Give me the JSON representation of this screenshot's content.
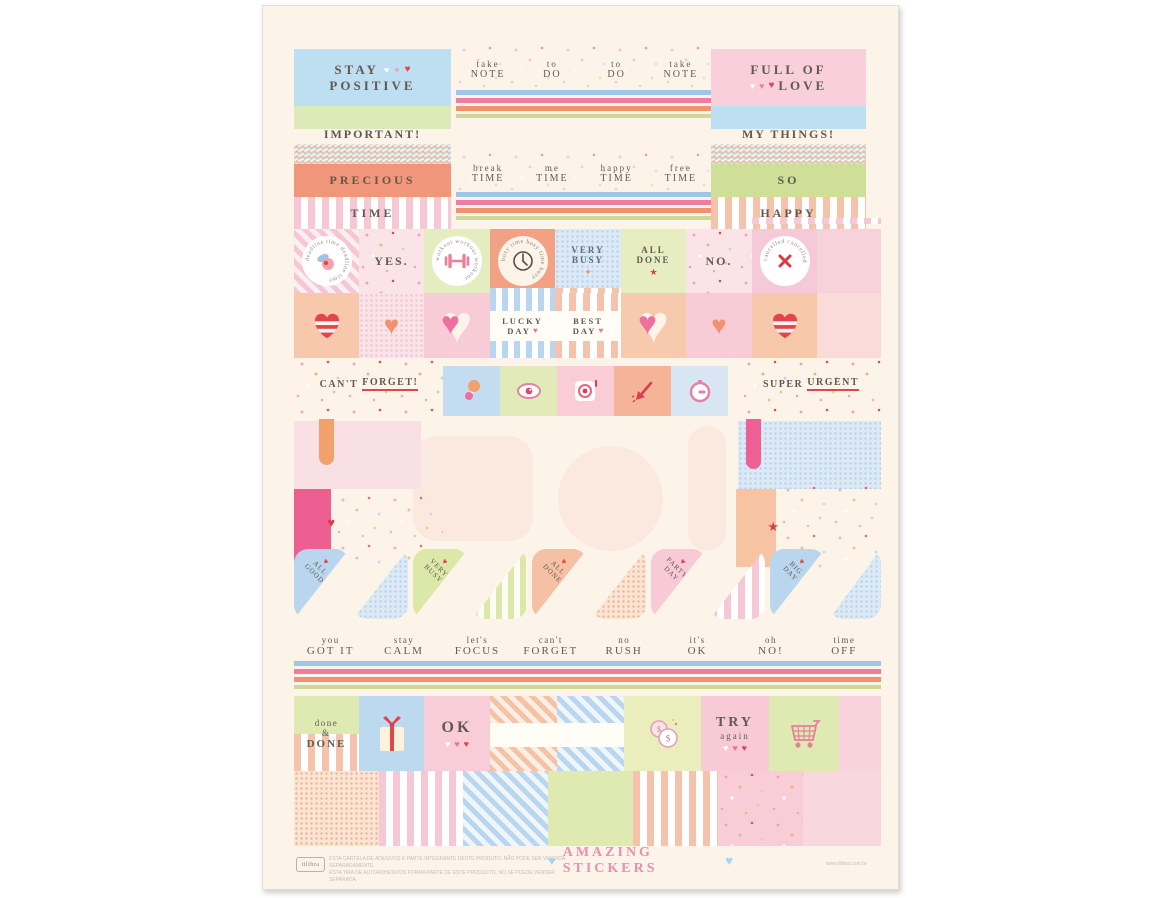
{
  "page": {
    "background": "#ffffff",
    "sheet_background": "#fdf4e9"
  },
  "icons": {
    "heart": "♥",
    "star": "★",
    "sparkle": "✦",
    "dollar": "$"
  },
  "colors": {
    "blue": "#bedff2",
    "green": "#dfe9b2",
    "pink": "#f8cdd8",
    "salmon": "#f0977b",
    "peach": "#f6c3a3",
    "red": "#e2454e",
    "hot_pink": "#ec5f90",
    "text": "#625a52",
    "title_pink": "#ea8fae"
  },
  "top_row": {
    "stay_positive": {
      "line1": "STAY",
      "line2": "POSITIVE"
    },
    "washi_notes": [
      {
        "top": "take",
        "bottom": "NOTE"
      },
      {
        "top": "to",
        "bottom": "DO"
      },
      {
        "top": "to",
        "bottom": "DO"
      },
      {
        "top": "take",
        "bottom": "NOTE"
      }
    ],
    "full_of_love": {
      "line1": "FULL OF",
      "line2": "LOVE"
    },
    "important": "IMPORTANT!",
    "my_things": "MY THINGS!",
    "precious_time": {
      "line1": "PRECIOUS",
      "line2": "TIME"
    },
    "washi_times": [
      {
        "top": "break",
        "bottom": "TIME"
      },
      {
        "top": "me",
        "bottom": "TIME"
      },
      {
        "top": "happy",
        "bottom": "TIME"
      },
      {
        "top": "free",
        "bottom": "TIME"
      }
    ],
    "so_happy": {
      "line1": "SO",
      "line2": "HAPPY"
    }
  },
  "circle_row": {
    "deadline_ring": "deadline time  deadline time",
    "yes": "YES.",
    "workout_ring": "workout  workout  workout",
    "busy_ring": "busy time  busy time  busy",
    "very_busy": {
      "line1": "VERY",
      "line2": "BUSY"
    },
    "all_done": {
      "line1": "ALL",
      "line2": "DONE"
    },
    "no": "NO.",
    "cancelled_ring": "cancelled  cancelled"
  },
  "hearts_row": {
    "lucky": {
      "line1": "LUCKY",
      "line2": "DAY"
    },
    "best": {
      "line1": "BEST",
      "line2": "DAY"
    }
  },
  "reminder_row": {
    "left_pre": "CAN'T",
    "left_underlined": "FORGET!",
    "right_pre": "SUPER",
    "right_underlined": "URGENT"
  },
  "flags": [
    {
      "line1": "ALL",
      "line2": "GOOD"
    },
    {
      "line1": "VERY",
      "line2": "BUSY"
    },
    {
      "line1": "ALL",
      "line2": "DONE"
    },
    {
      "line1": "PARTY",
      "line2": "DAY"
    },
    {
      "line1": "BIG",
      "line2": "DAY"
    }
  ],
  "phrases": [
    {
      "top": "you",
      "bottom": "GOT IT"
    },
    {
      "top": "stay",
      "bottom": "CALM"
    },
    {
      "top": "let's",
      "bottom": "FOCUS"
    },
    {
      "top": "can't",
      "bottom": "FORGET"
    },
    {
      "top": "no",
      "bottom": "RUSH"
    },
    {
      "top": "it's",
      "bottom": "OK"
    },
    {
      "top": "oh",
      "bottom": "NO!"
    },
    {
      "top": "time",
      "bottom": "OFF"
    }
  ],
  "bottom_row": {
    "done": {
      "line1": "done",
      "line2": "&",
      "line3": "DONE"
    },
    "ok": "OK",
    "try": {
      "line1": "TRY",
      "line2": "again"
    }
  },
  "footer": {
    "brand": "tilibra",
    "legal_line1": "ESTA CARTELA DE ADESIVOS É PARTE INTEGRANTE DESTE PRODUTO. NÃO PODE SER VENDIDA SEPARADAMENTE.",
    "legal_line2": "ESTA TIRA DE AUTOADHESIVOS FORMA PARTE DE ESTE PRODUCTO. NO SE PUEDE VENDER SEPARADA.",
    "title": "AMAZING STICKERS",
    "website": "www.tilibra.com.br"
  }
}
